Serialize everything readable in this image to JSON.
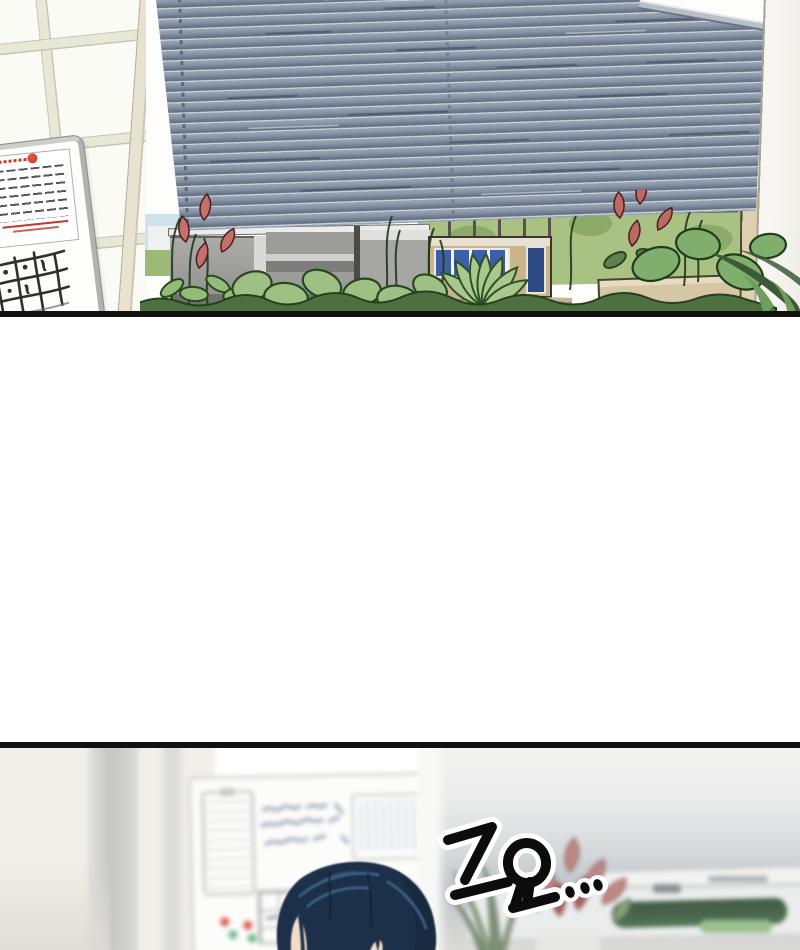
{
  "panel2": {
    "sfx_text": "고요..."
  },
  "colors": {
    "panel_border": "#111111",
    "blinds": "#8a97a9",
    "blinds_highlight": "#ccd3da",
    "blinds_shadow": "#606d7f",
    "blinds_rail": "#b7bfc9",
    "wall_tile": "#fbfbf6",
    "tile_grout": "#e9e7d6",
    "tile_grout_edge": "#c6c6b4",
    "window_frame": "#e8e2d0",
    "hedge": "#a9c183",
    "hedge_light": "#c8d9ab",
    "hedge_outline": "#3a5a30",
    "leaf": "#94bb78",
    "leaf_dark_outline": "#27481f",
    "leaf_deep": "#4e7040",
    "palm": "#3c5a38",
    "flower_red": "#c4706e",
    "flower_red_right": "#bb6a68",
    "partition_grey": "#a0a09e",
    "partition_dark": "#6f6f6d",
    "kiosk_tan": "#c9b48c",
    "kiosk_blue": "#3c5fa7",
    "planter_tan": "#d5c6a5",
    "pillar_tan": "#ddd0ae",
    "sky": "#cfe2ea",
    "grass": "#9cb975",
    "board2_frame": "#d6d6d4",
    "clipboard_line": "#b8b8b6",
    "scribble_blue": "#98a2b4",
    "chart_line": "#c3cbdb",
    "chart_red_mark": "#c23b2e",
    "magnet_red": "#cf4335",
    "magnet_green": "#58a87a",
    "paper_ink": "#3a3a3c",
    "paper_red_ink": "#c0392b",
    "tally_ink": "#2f2f2f",
    "wall_cream": "#f1efe9",
    "wall_stripe_grey": "#c4c6c4",
    "hair": "#1d3049",
    "hair_shadow": "#152439",
    "hair_highlight": "#3e6186",
    "skin": "#f1dcc7",
    "fog_grey": "#bfc5cb",
    "desk_white": "#ebecec",
    "shelf_green": "#49654c",
    "shelf_green_light": "#9cc08f",
    "plant2_green": "#93a487",
    "plant2_red": "#bd8886",
    "sfx_ink": "#0c0c0c",
    "sfx_outline": "#ffffff"
  }
}
